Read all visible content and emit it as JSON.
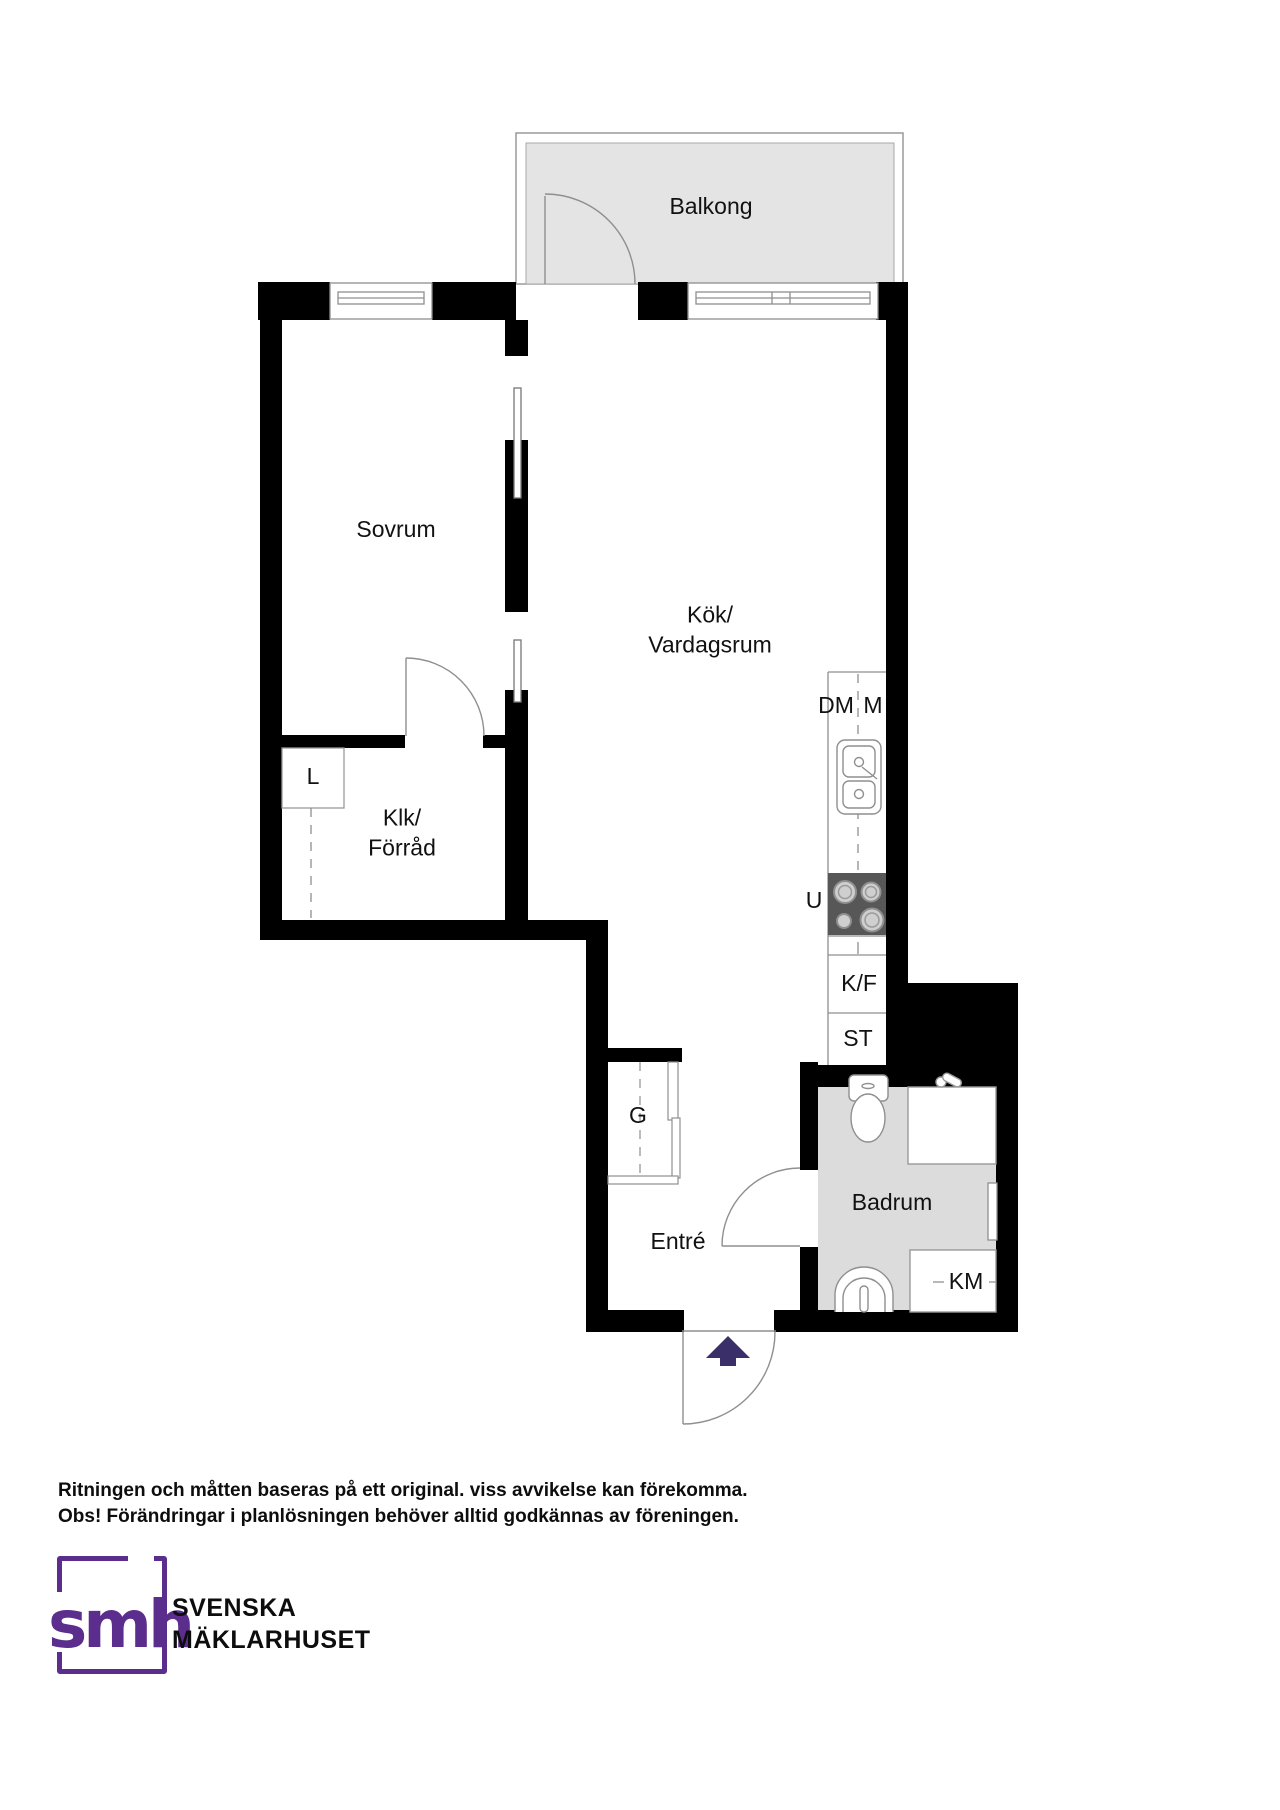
{
  "floorplan": {
    "rooms": {
      "balkong": "Balkong",
      "sovrum": "Sovrum",
      "kok_line1": "Kök/",
      "kok_line2": "Vardagsrum",
      "klk_line1": "Klk/",
      "klk_line2": "Förråd",
      "badrum": "Badrum",
      "entre": "Entré"
    },
    "fixtures": {
      "linen_closet": "L",
      "wardrobe": "G",
      "dishwasher": "DM",
      "microwave": "M",
      "oven": "U",
      "fridge_freezer": "K/F",
      "pantry": "ST",
      "washing_machine": "KM"
    },
    "colors": {
      "wall": "#000000",
      "balcony_floor": "#e4e4e5",
      "bathroom_floor": "#dcdcdc",
      "stove": "#575757",
      "entry_arrow": "#3a2f68",
      "thin_line": "#8f8f8f",
      "logo_purple": "#5b2d8c"
    }
  },
  "disclaimer": {
    "line1": "Ritningen och måtten baseras på ett original. viss avvikelse kan förekomma.",
    "line2": "Obs! Förändringar i planlösningen behöver alltid godkännas av föreningen."
  },
  "branding": {
    "logo_text": "smh",
    "company_line1": "SVENSKA",
    "company_line2": "MÄKLARHUSET"
  }
}
